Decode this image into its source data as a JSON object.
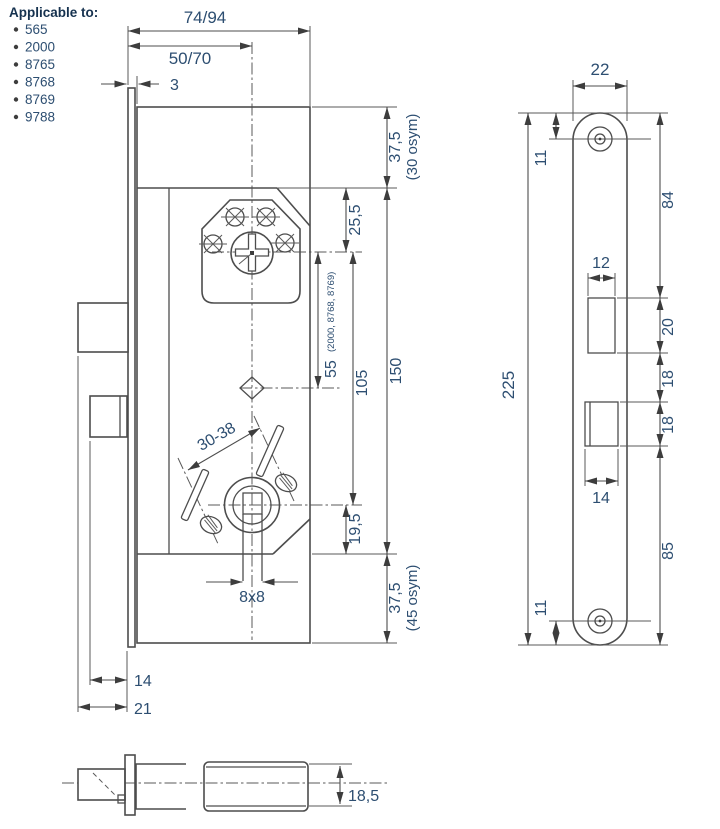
{
  "colors": {
    "line": "#4d4d4d",
    "dimension_text": "#2d4e71",
    "header_text": "#16324f",
    "background": "#ffffff"
  },
  "applicable_to": {
    "title": "Applicable to:",
    "items": [
      "565",
      "2000",
      "8765",
      "8768",
      "8769",
      "9788"
    ]
  },
  "left_view": {
    "dim_total_width": "74/94",
    "dim_backset": "50/70",
    "dim_faceplate_thickness": "3",
    "dim_top_margin": "37,5",
    "dim_top_margin_note": "(30 osym)",
    "dim_cylinder_offset": "25,5",
    "dim_alt_centre": "55",
    "dim_alt_centre_note": "(2000, 8768, 8769)",
    "dim_centre_distance": "105",
    "dim_case_height": "150",
    "dim_follower_offset": "19,5",
    "dim_bottom_margin": "37,5",
    "dim_bottom_margin_note": "(45 osym)",
    "dim_screw_spacing": "30-38",
    "dim_spindle_hole": "8x8",
    "dim_deadbolt_throw": "14",
    "dim_latch_throw": "21"
  },
  "front_view": {
    "dim_faceplate_width": "22",
    "dim_top_screw_offset": "11",
    "dim_top_to_latch": "84",
    "dim_latch_cutout_width": "12",
    "dim_latch_cutout_height": "20",
    "dim_latch_to_deadbolt_gap": "18",
    "dim_deadbolt_cutout_height": "18",
    "dim_deadbolt_cutout_width": "14",
    "dim_deadbolt_to_bottom": "85",
    "dim_bottom_screw_offset": "11",
    "dim_faceplate_length": "225"
  },
  "side_view": {
    "dim_case_thickness": "18,5"
  }
}
